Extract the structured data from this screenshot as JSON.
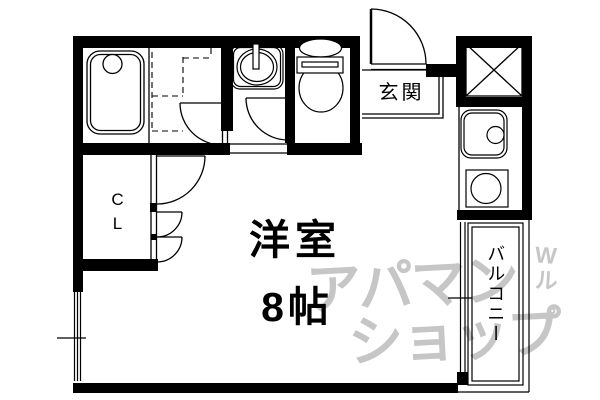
{
  "labels": {
    "entrance": "玄関",
    "room": "洋室",
    "room_size": "8帖",
    "balcony": "バルコニー",
    "closet": "CL"
  },
  "watermark": {
    "line1": "アパマン",
    "line2": "ショップ",
    "side_marks": "Wル゜"
  },
  "colors": {
    "line": "#000000",
    "background": "#ffffff",
    "watermark": "#c6c6c6"
  }
}
